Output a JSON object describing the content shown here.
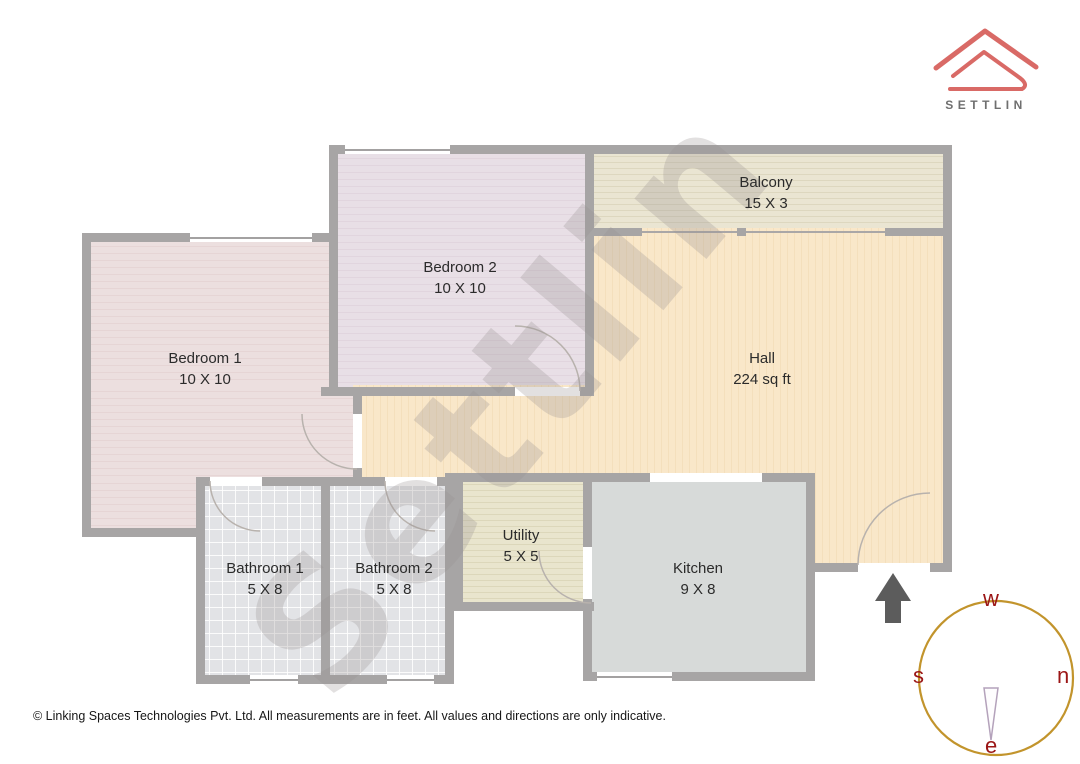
{
  "watermark": "Settlin",
  "logo": {
    "name": "SETTLIN",
    "house_color": "#d96a66",
    "text_color": "#6f6f6f"
  },
  "rooms": {
    "bedroom1": {
      "name": "Bedroom 1",
      "dim": "10 X 10"
    },
    "bedroom2": {
      "name": "Bedroom 2",
      "dim": "10 X 10"
    },
    "balcony": {
      "name": "Balcony",
      "dim": "15 X 3"
    },
    "hall": {
      "name": "Hall",
      "dim": "224 sq ft"
    },
    "utility": {
      "name": "Utility",
      "dim": "5 X 5"
    },
    "kitchen": {
      "name": "Kitchen",
      "dim": "9 X 8"
    },
    "bathroom1": {
      "name": "Bathroom 1",
      "dim": "5 X 8"
    },
    "bathroom2": {
      "name": "Bathroom 2",
      "dim": "5 X 8"
    }
  },
  "compass": {
    "top": "w",
    "right": "n",
    "left": "s",
    "bottom": "e",
    "ring_color": "#c2942c",
    "letter_color": "#9b1616"
  },
  "entrance_arrow_color": "#5c5c5c",
  "footer": "© Linking Spaces Technologies Pvt. Ltd. All measurements are in feet. All values and directions are only indicative."
}
